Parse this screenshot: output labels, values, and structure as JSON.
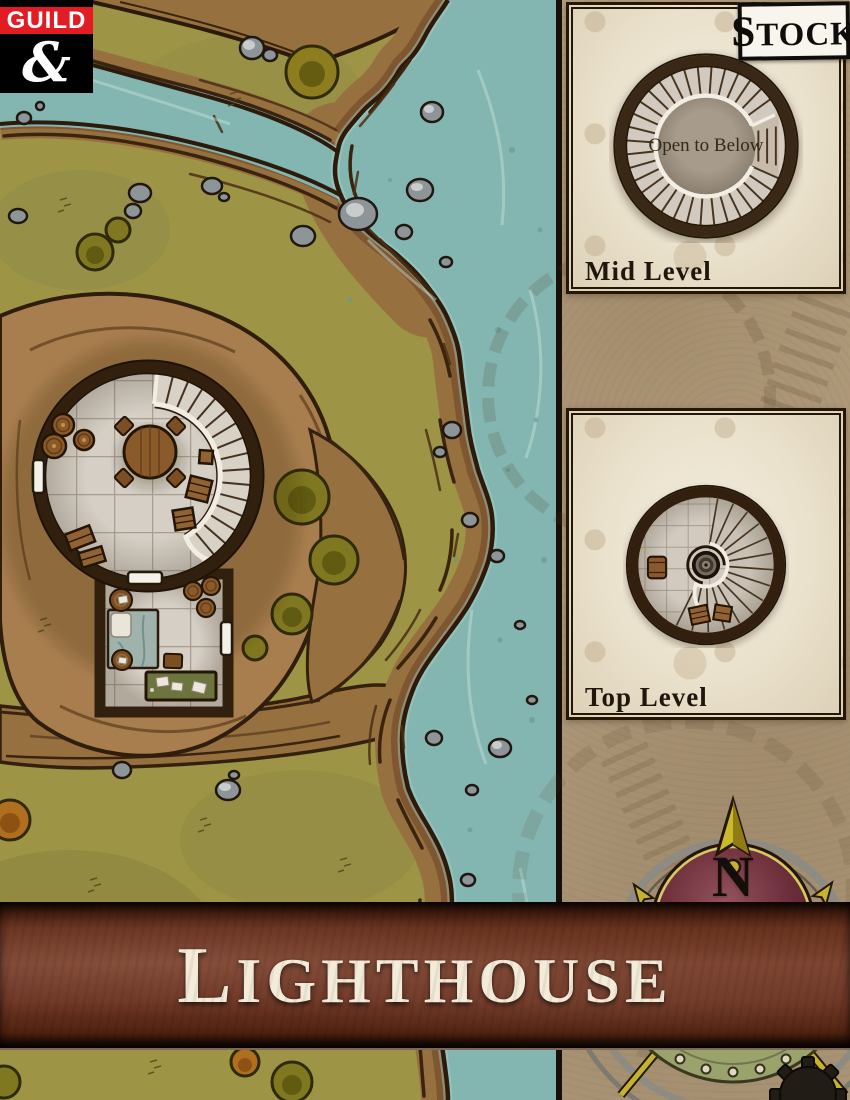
{
  "title_banner": {
    "title": "Lighthouse"
  },
  "logo": {
    "publisher": "GUILD",
    "ampersand_glyph": "&"
  },
  "stock_badge": {
    "label": "Stock"
  },
  "sidebar": {
    "mid_panel": {
      "label": "Mid Level",
      "center_text": "Open to Below"
    },
    "top_panel": {
      "label": "Top Level"
    },
    "compass": {
      "north_label": "N"
    }
  },
  "colors": {
    "logo_red": "#e31b23",
    "water": "#83b6b0",
    "grass": "#9d9446",
    "cliff": "#96713f",
    "dirt": "#a87e4e",
    "parchment": "#b49f80",
    "panel_cream": "#ece3d0",
    "banner_leather": "#6f3a2a",
    "ink": "#2c1a0c",
    "stone_floor": "#d5cec4",
    "compass_maroon": "#6b2e3a",
    "compass_gold": "#c6b32c"
  }
}
